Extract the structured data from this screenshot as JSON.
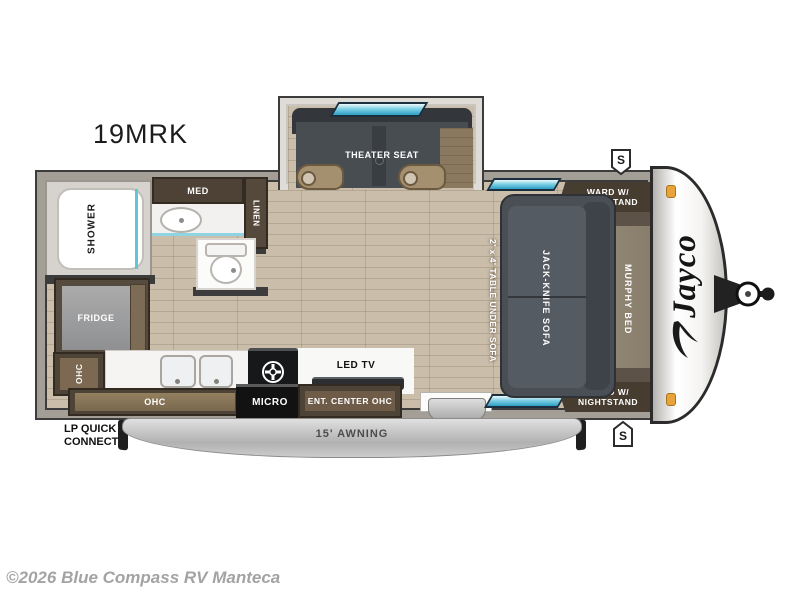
{
  "title": "19MRK",
  "brand": {
    "logo": "Jayco"
  },
  "exterior": {
    "awning": "15' AWNING",
    "lp": {
      "line1": "LP QUICK",
      "line2": "CONNECT"
    },
    "speaker_top": "S",
    "speaker_bottom": "S"
  },
  "rooms": {
    "slideout": {
      "theater_seat": "THEATER SEAT"
    },
    "bathroom": {
      "shower": "SHOWER",
      "med": "MED",
      "linen": "LINEN"
    },
    "kitchen": {
      "fridge": "FRIDGE",
      "ohc_side": "OHC",
      "ohc_lower": "OHC",
      "micro": "MICRO"
    },
    "living": {
      "led_tv": "LED TV",
      "ent_center": "ENT. CENTER OHC",
      "sofa": "JACK-KNIFE SOFA",
      "table": "2' x 4' TABLE UNDER SOFA"
    },
    "bedroom": {
      "murphy_bed": "MURPHY BED",
      "ward_top": {
        "line1": "WARD W/",
        "line2": "NIGHTSTAND"
      },
      "ward_bottom": {
        "line1": "WARD W/",
        "line2": "NIGHTSTAND"
      }
    }
  },
  "footer": {
    "copyright": "©2026 Blue Compass RV Manteca"
  },
  "colors": {
    "wall": "#3c3c3c",
    "floor_wood": "#c8bba8",
    "cabinet_dark": "#4e4337",
    "seat_gray": "#4a4f55",
    "bed_tan": "#8e8274",
    "window_teal": "#7ed0e4",
    "marker_amber": "#e8a33c",
    "awning_gray": "#c2c2c2"
  }
}
